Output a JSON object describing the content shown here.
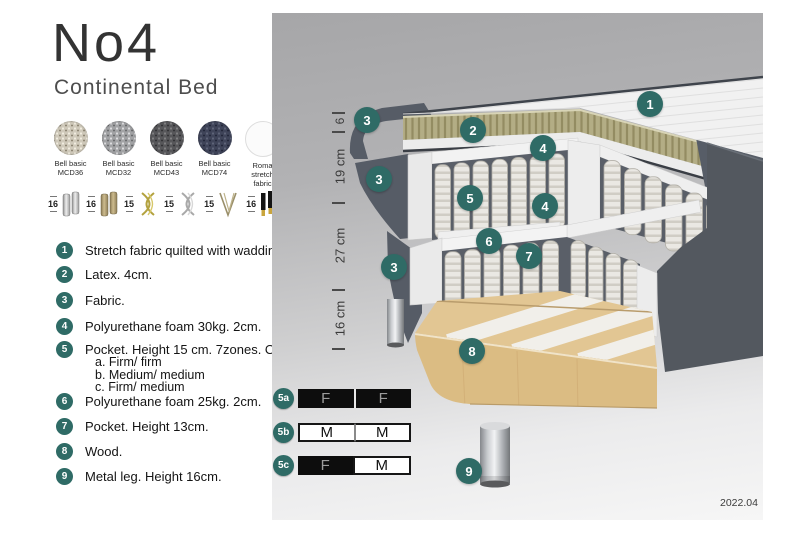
{
  "header": {
    "title": "No4",
    "subtitle": "Continental Bed"
  },
  "fabrics": [
    {
      "name": "Bell basic",
      "code": "MCD36"
    },
    {
      "name": "Bell basic",
      "code": "MCD32"
    },
    {
      "name": "Bell basic",
      "code": "MCD43"
    },
    {
      "name": "Bell basic",
      "code": "MCD74"
    },
    {
      "name": "Roma",
      "code": "stretch fabric"
    }
  ],
  "leg_options": [
    {
      "height": "16",
      "icon": "cylinder-chrome-leg"
    },
    {
      "height": "16",
      "icon": "cylinder-wood-leg"
    },
    {
      "height": "15",
      "icon": "twisted-gold-leg"
    },
    {
      "height": "15",
      "icon": "twisted-silver-leg"
    },
    {
      "height": "15",
      "icon": "hairpin-leg"
    },
    {
      "height": "16",
      "icon": "tapered-black-gold-leg"
    }
  ],
  "features": [
    {
      "num": "1",
      "text": "Stretch fabric quilted with wadding."
    },
    {
      "num": "2",
      "text": "Latex. 4cm."
    },
    {
      "num": "3",
      "text": "Fabric."
    },
    {
      "num": "4",
      "text": "Polyurethane foam 30kg. 2cm."
    },
    {
      "num": "5",
      "text": "Pocket. Height 15 cm. 7zones. Option:",
      "options": [
        "a. Firm/ firm",
        "b. Medium/ medium",
        "c. Firm/ medium"
      ]
    },
    {
      "num": "6",
      "text": "Polyurethane foam 25kg. 2cm."
    },
    {
      "num": "7",
      "text": "Pocket. Height 13cm."
    },
    {
      "num": "8",
      "text": "Wood."
    },
    {
      "num": "9",
      "text": "Metal leg. Height 16cm."
    }
  ],
  "diagram": {
    "dimensions": [
      {
        "label": "6"
      },
      {
        "label": "19 cm"
      },
      {
        "label": "27 cm"
      },
      {
        "label": "16 cm"
      }
    ],
    "markers": [
      {
        "label": "1"
      },
      {
        "label": "2"
      },
      {
        "label": "3"
      },
      {
        "label": "3"
      },
      {
        "label": "3"
      },
      {
        "label": "4"
      },
      {
        "label": "4"
      },
      {
        "label": "5"
      },
      {
        "label": "6"
      },
      {
        "label": "7"
      },
      {
        "label": "8"
      },
      {
        "label": "9"
      }
    ]
  },
  "firmness": [
    {
      "id": "5a",
      "cells": [
        {
          "label": "F",
          "style": "dark"
        },
        {
          "label": "F",
          "style": "dark"
        }
      ]
    },
    {
      "id": "5b",
      "cells": [
        {
          "label": "M",
          "style": "light"
        },
        {
          "label": "M",
          "style": "light"
        }
      ]
    },
    {
      "id": "5c",
      "cells": [
        {
          "label": "F",
          "style": "dark"
        },
        {
          "label": "M",
          "style": "light"
        }
      ]
    }
  ],
  "footer": {
    "version": "2022.04"
  },
  "colors": {
    "accent": "#2F6B66",
    "dark_fabric": "#53585F",
    "latex": "#B1AB83",
    "wood": "#DDBE86"
  }
}
